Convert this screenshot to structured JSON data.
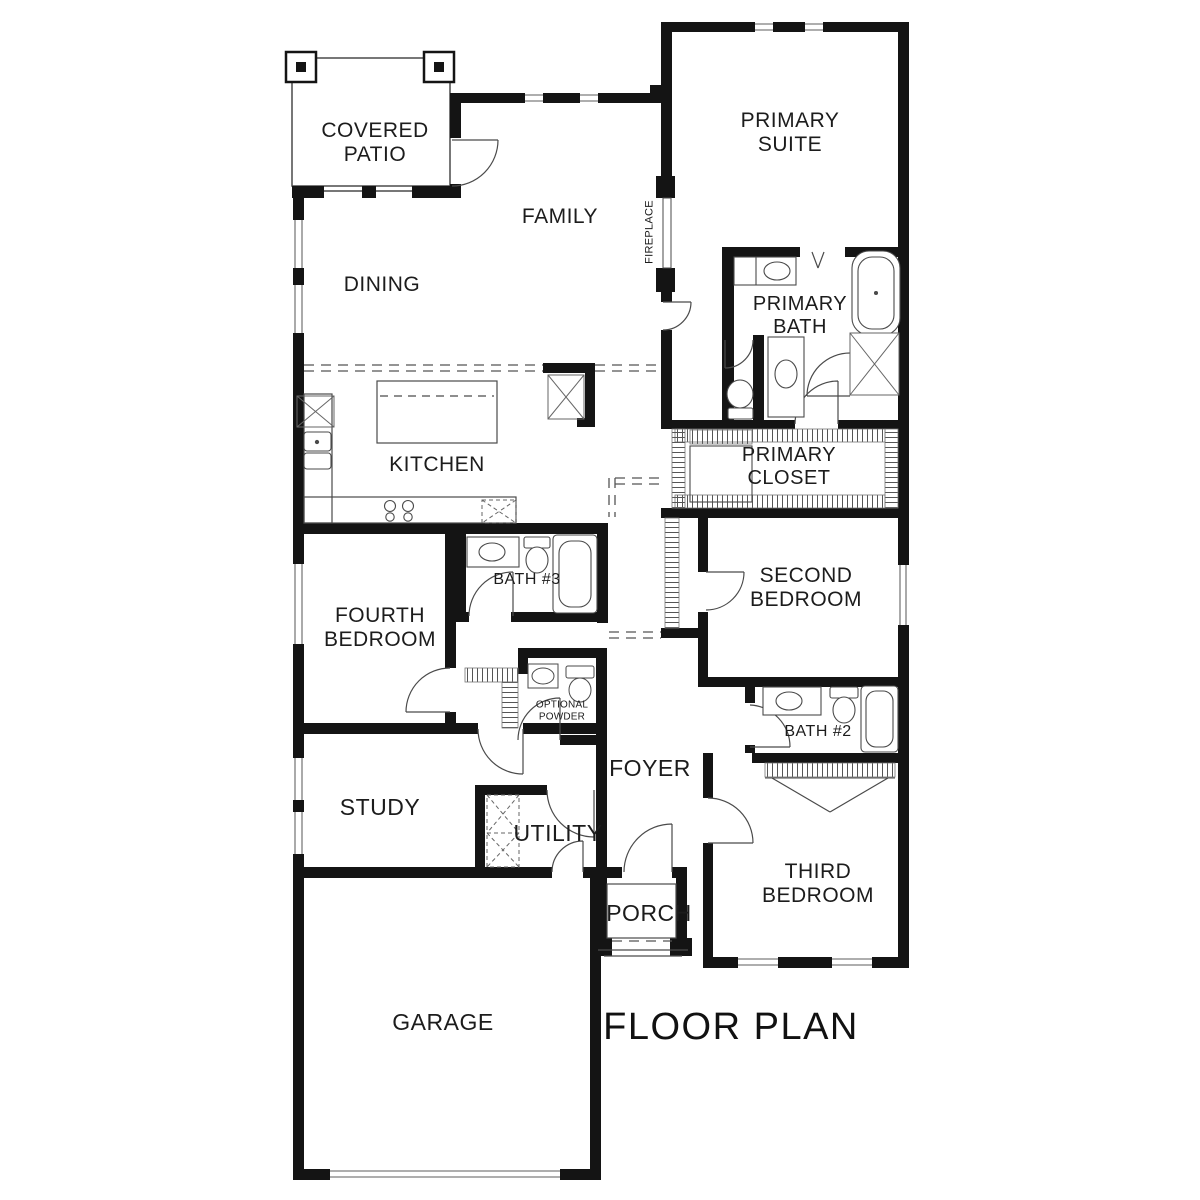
{
  "title": {
    "text": "FLOOR PLAN"
  },
  "rooms": {
    "covered_patio": {
      "label": "COVERED\nPATIO"
    },
    "family": {
      "label": "FAMILY"
    },
    "dining": {
      "label": "DINING"
    },
    "fireplace": {
      "label": "FIREPLACE"
    },
    "primary_suite": {
      "label": "PRIMARY\nSUITE"
    },
    "primary_bath": {
      "label": "PRIMARY\nBATH"
    },
    "kitchen": {
      "label": "KITCHEN"
    },
    "primary_closet": {
      "label": "PRIMARY\nCLOSET"
    },
    "bath3": {
      "label": "BATH #3"
    },
    "fourth_bedroom": {
      "label": "FOURTH\nBEDROOM"
    },
    "second_bedroom": {
      "label": "SECOND\nBEDROOM"
    },
    "optional_powder": {
      "label": "OPTIONAL\nPOWDER"
    },
    "foyer": {
      "label": "FOYER"
    },
    "bath2": {
      "label": "BATH #2"
    },
    "study": {
      "label": "STUDY"
    },
    "utility": {
      "label": "UTILITY"
    },
    "third_bedroom": {
      "label": "THIRD\nBEDROOM"
    },
    "porch": {
      "label": "PORCH"
    },
    "garage": {
      "label": "GARAGE"
    }
  },
  "colors": {
    "wall": "#141414",
    "thin_line": "#4a4a4a",
    "hatch": "#6a6a6a",
    "text": "#1c1c1c"
  }
}
